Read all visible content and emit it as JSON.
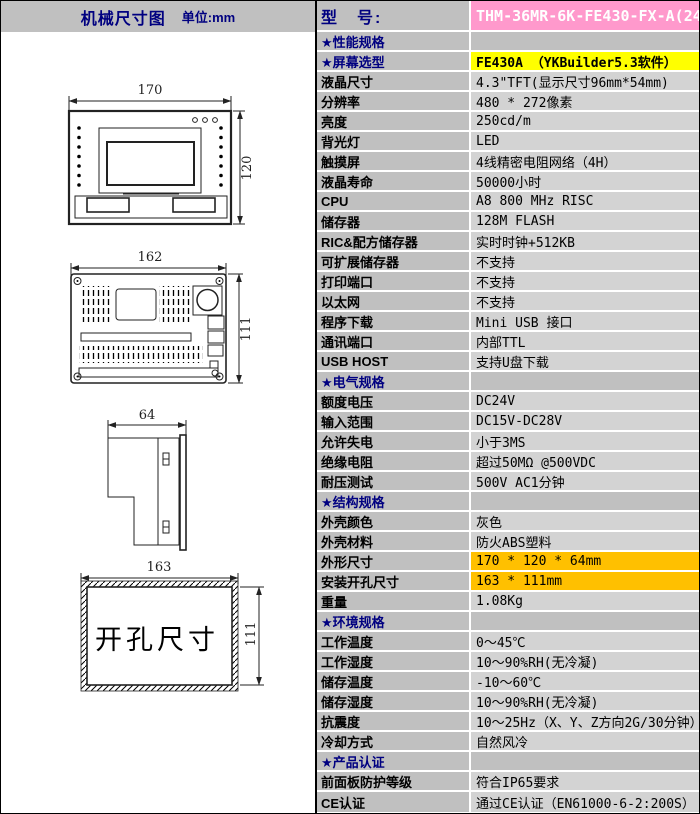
{
  "header": {
    "left_title": "机械尺寸图",
    "unit": "单位:mm",
    "model_label": "型　号:",
    "model_value": "THM-36MR-6K-FE430-FX-A(24V)"
  },
  "colors": {
    "label_bg": "#C0C0C0",
    "value_bg": "#D3D3D3",
    "pink": "#FF99CC",
    "yellow": "#FFFF00",
    "gold": "#FFC000",
    "navy": "#000080"
  },
  "table": {
    "rows": [
      {
        "label": "★性能规格",
        "value": "",
        "star": true,
        "section": true
      },
      {
        "label": "★屏幕选型",
        "value": "FE430A （YKBuilder5.3软件）",
        "star": true,
        "bg": "yellow"
      },
      {
        "label": "液晶尺寸",
        "value": "4.3\"TFT(显示尺寸96mm*54mm)"
      },
      {
        "label": "分辨率",
        "value": "480 * 272像素"
      },
      {
        "label": "亮度",
        "value": "250cd/m"
      },
      {
        "label": "背光灯",
        "value": "LED"
      },
      {
        "label": "触摸屏",
        "value": "4线精密电阻网络（4H）"
      },
      {
        "label": "液晶寿命",
        "value": "50000小时"
      },
      {
        "label": "CPU",
        "value": "A8 800 MHz RISC"
      },
      {
        "label": "储存器",
        "value": "128M FLASH"
      },
      {
        "label": "RIC&配方储存器",
        "value": "实时时钟+512KB"
      },
      {
        "label": "可扩展储存器",
        "value": "不支持"
      },
      {
        "label": "打印端口",
        "value": "不支持"
      },
      {
        "label": "以太网",
        "value": "不支持"
      },
      {
        "label": "程序下载",
        "value": "Mini USB 接口"
      },
      {
        "label": "通讯端口",
        "value": "内部TTL"
      },
      {
        "label": "USB HOST",
        "value": "支持U盘下载"
      },
      {
        "label": "★电气规格",
        "value": "",
        "star": true,
        "section": true
      },
      {
        "label": "额度电压",
        "value": "DC24V"
      },
      {
        "label": "输入范围",
        "value": "DC15V-DC28V"
      },
      {
        "label": "允许失电",
        "value": "小于3MS"
      },
      {
        "label": "绝缘电阻",
        "value": "超过50MΩ @500VDC"
      },
      {
        "label": "耐压测试",
        "value": "500V AC1分钟"
      },
      {
        "label": "★结构规格",
        "value": "",
        "star": true,
        "section": true
      },
      {
        "label": "外壳颜色",
        "value": "灰色"
      },
      {
        "label": "外壳材料",
        "value": "防火ABS塑料"
      },
      {
        "label": "外形尺寸",
        "value": "170 * 120 * 64mm",
        "bg": "gold"
      },
      {
        "label": "安装开孔尺寸",
        "value": "163 * 111mm",
        "bg": "gold"
      },
      {
        "label": "重量",
        "value": "1.08Kg"
      },
      {
        "label": "★环境规格",
        "value": "",
        "star": true,
        "section": true
      },
      {
        "label": "工作温度",
        "value": "0～45℃"
      },
      {
        "label": "工作湿度",
        "value": "10～90%RH(无冷凝)"
      },
      {
        "label": "储存温度",
        "value": "-10～60℃"
      },
      {
        "label": "储存湿度",
        "value": "10～90%RH(无冷凝)"
      },
      {
        "label": "抗震度",
        "value": "10～25Hz（X、Y、Z方向2G/30分钟）"
      },
      {
        "label": "冷却方式",
        "value": "自然风冷"
      },
      {
        "label": "★产品认证",
        "value": "",
        "star": true,
        "section": true
      },
      {
        "label": "前面板防护等级",
        "value": "符合IP65要求"
      },
      {
        "label": "CE认证",
        "value": "通过CE认证（EN61000-6-2:200S）"
      }
    ]
  },
  "drawings": {
    "front": {
      "width_dim": "170",
      "height_dim": "120"
    },
    "rear": {
      "width_dim": "162",
      "height_dim": "111"
    },
    "side": {
      "depth_dim": "64"
    },
    "cutout": {
      "width_dim": "163",
      "height_dim": "111",
      "label": "开孔尺寸"
    }
  }
}
